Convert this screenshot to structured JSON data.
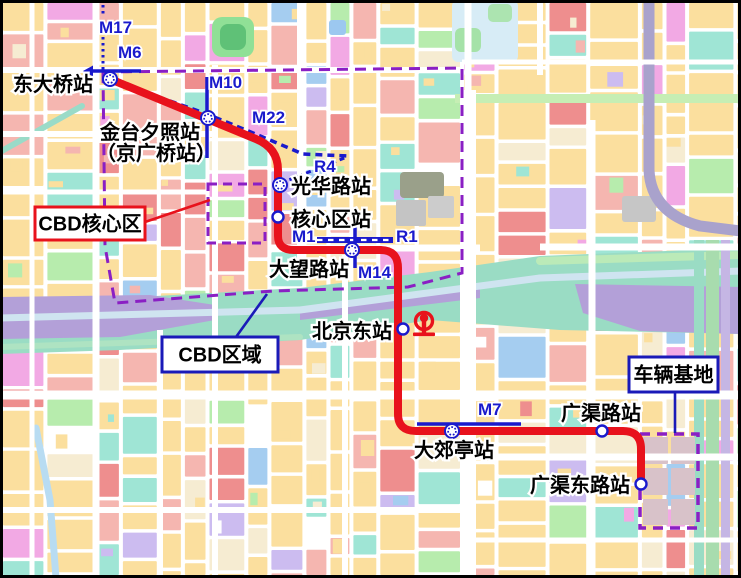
{
  "map": {
    "region_labels": {
      "core": "CBD核心区",
      "cbd": "CBD区域",
      "depot": "车辆基地"
    },
    "stations": [
      {
        "name": "东大桥站",
        "x": 110,
        "y": 79,
        "type": "interchange",
        "label": {
          "x": 13,
          "y": 91,
          "lines": [
            "东大桥站"
          ]
        }
      },
      {
        "name": "金台夕照站（京广桥站）",
        "x": 208,
        "y": 118,
        "type": "interchange",
        "label": {
          "x": 100,
          "y": 139,
          "lines": [
            "金台夕照站",
            "（京广桥站）"
          ],
          "x2": 96,
          "y2": 160
        }
      },
      {
        "name": "光华路站",
        "x": 280,
        "y": 185,
        "type": "interchange",
        "label": {
          "x": 291,
          "y": 193,
          "lines": [
            "光华路站"
          ]
        }
      },
      {
        "name": "核心区站",
        "x": 278,
        "y": 217,
        "type": "regular",
        "label": {
          "x": 291,
          "y": 226,
          "lines": [
            "核心区站"
          ]
        }
      },
      {
        "name": "大望路站",
        "x": 352,
        "y": 250,
        "type": "interchange",
        "label": {
          "x": 269,
          "y": 276,
          "lines": [
            "大望路站"
          ]
        }
      },
      {
        "name": "北京东站",
        "x": 403,
        "y": 329,
        "type": "regular",
        "label": {
          "x": 312,
          "y": 338,
          "lines": [
            "北京东站"
          ]
        }
      },
      {
        "name": "大郊亭站",
        "x": 452,
        "y": 431,
        "type": "interchange",
        "label": {
          "x": 414,
          "y": 457,
          "lines": [
            "大郊亭站"
          ]
        }
      },
      {
        "name": "广渠路站",
        "x": 602,
        "y": 431,
        "type": "regular",
        "label": {
          "x": 561,
          "y": 420,
          "lines": [
            "广渠路站"
          ]
        }
      },
      {
        "name": "广渠东路站",
        "x": 641,
        "y": 484,
        "type": "regular",
        "label": {
          "x": 530,
          "y": 492,
          "lines": [
            "广渠东路站"
          ]
        }
      }
    ],
    "line_labels": [
      {
        "text": "M17",
        "x": 99,
        "y": 33
      },
      {
        "text": "M6",
        "x": 118,
        "y": 58
      },
      {
        "text": "M10",
        "x": 209,
        "y": 88
      },
      {
        "text": "M22",
        "x": 252,
        "y": 123
      },
      {
        "text": "R4",
        "x": 314,
        "y": 172
      },
      {
        "text": "M1",
        "x": 292,
        "y": 242
      },
      {
        "text": "R1",
        "x": 396,
        "y": 242
      },
      {
        "text": "M14",
        "x": 358,
        "y": 278
      },
      {
        "text": "M7",
        "x": 478,
        "y": 415
      }
    ],
    "red_line": {
      "path": "M 110,79 L 256,139 Q 278,148 278,170 L 278,236 Q 278,250 294,250 L 380,250 Q 398,250 398,268 L 398,414 Q 398,431 416,431 L 623,431 Q 641,431 641,449 L 641,484"
    },
    "metro_lines": [
      {
        "id": "M17",
        "style": "dotted",
        "pts": [
          [
            103,
            5
          ],
          [
            103,
            17
          ]
        ]
      },
      {
        "id": "M17",
        "style": "dotted",
        "pts": [
          [
            103,
            37
          ],
          [
            103,
            71
          ]
        ]
      },
      {
        "id": "M6",
        "style": "solid",
        "pts": [
          [
            88,
            71
          ],
          [
            141,
            71
          ]
        ],
        "arrow": [
          [
            83,
            71
          ],
          [
            93,
            65.5
          ],
          [
            93,
            76.5
          ]
        ]
      },
      {
        "id": "M10",
        "style": "solid",
        "pts": [
          [
            207,
            77
          ],
          [
            207,
            158
          ]
        ]
      },
      {
        "id": "M22",
        "style": "dashed",
        "pts": [
          [
            113,
            81
          ],
          [
            207,
            114
          ],
          [
            258,
            135
          ],
          [
            303,
            154
          ],
          [
            348,
            156
          ]
        ]
      },
      {
        "id": "R4",
        "style": "dashed2",
        "pts": [
          [
            281,
            183
          ],
          [
            347,
            157
          ]
        ]
      },
      {
        "id": "M1/R1",
        "style": "dashdot",
        "pts": [
          [
            317,
            240
          ],
          [
            393,
            240
          ]
        ]
      },
      {
        "id": "M14",
        "style": "solid",
        "pts": [
          [
            355,
            221
          ],
          [
            355,
            268
          ]
        ]
      },
      {
        "id": "M7",
        "style": "solid",
        "pts": [
          [
            417,
            424
          ],
          [
            521,
            424
          ]
        ]
      }
    ],
    "boundaries": {
      "cbd_polygon": [
        [
          103,
          72
        ],
        [
          462,
          68
        ],
        [
          462,
          273
        ],
        [
          408,
          287
        ],
        [
          273,
          291
        ],
        [
          115,
          303
        ],
        [
          105,
          246
        ]
      ],
      "core_rect": {
        "x": 208,
        "y": 184,
        "w": 57,
        "h": 59
      },
      "depot_rect": {
        "x": 640,
        "y": 434,
        "w": 58,
        "h": 94
      }
    },
    "railway_icon": {
      "x": 424,
      "y": 321
    },
    "callouts": [
      {
        "key": "core",
        "box": {
          "x": 35,
          "y": 207,
          "w": 110,
          "h": 33
        },
        "border": "#e8121c",
        "leader": [
          [
            145,
            222
          ],
          [
            210,
            200
          ]
        ]
      },
      {
        "key": "cbd",
        "box": {
          "x": 162,
          "y": 337,
          "w": 116,
          "h": 35
        },
        "border": "#1a1ab8",
        "leader": [
          [
            236,
            337
          ],
          [
            267,
            294
          ]
        ]
      },
      {
        "key": "depot",
        "box": {
          "x": 629,
          "y": 357,
          "w": 89,
          "h": 35
        },
        "border": "#1a1ab8",
        "leader": [
          [
            675,
            392
          ],
          [
            675,
            433
          ]
        ]
      }
    ],
    "colors": {
      "metro_blue": "#1a1acc",
      "line_red": "#e8121c",
      "boundary_purple": "#8a1fc4",
      "callout_blue": "#1a1ab8",
      "palette": {
        "yellow": "#fbdf9e",
        "cream": "#f6ecd2",
        "pink": "#f5b6b0",
        "red": "#ee8e8e",
        "teal": "#9fe5d5",
        "green": "#b7ecad",
        "magenta": "#f2a9e4",
        "lavender": "#ccbcf0",
        "blue": "#a5cdf0"
      }
    },
    "features": [
      {
        "shape": "line",
        "x1": 0,
        "y1": 152,
        "x2": 82,
        "y2": 106,
        "w": 6,
        "color": "#9adbc8"
      },
      {
        "shape": "rect",
        "x": 212,
        "y": 17,
        "w": 42,
        "h": 40,
        "rx": 10,
        "color": "#90e096"
      },
      {
        "shape": "rect",
        "x": 220,
        "y": 24,
        "w": 26,
        "h": 26,
        "rx": 8,
        "color": "#5fc177"
      },
      {
        "shape": "rect",
        "x": 329,
        "y": 20,
        "w": 17,
        "h": 15,
        "rx": 3,
        "color": "#9cc8f0"
      },
      {
        "shape": "rect",
        "x": 452,
        "y": 0,
        "w": 66,
        "h": 62,
        "rx": 6,
        "color": "#d7ecf6"
      },
      {
        "shape": "rect",
        "x": 455,
        "y": 28,
        "w": 26,
        "h": 24,
        "rx": 6,
        "color": "#a5e2a8"
      },
      {
        "shape": "rect",
        "x": 488,
        "y": 4,
        "w": 24,
        "h": 18,
        "rx": 5,
        "color": "#ace4b0"
      },
      {
        "shape": "rect",
        "x": 455,
        "y": 94,
        "w": 286,
        "h": 9,
        "rx": 0,
        "color": "#c6eeb4"
      },
      {
        "shape": "rect",
        "x": 400,
        "y": 172,
        "w": 44,
        "h": 26,
        "rx": 4,
        "color": "#9aa08a"
      },
      {
        "shape": "rect",
        "x": 396,
        "y": 200,
        "w": 30,
        "h": 26,
        "rx": 2,
        "color": "#c4c4c4"
      },
      {
        "shape": "rect",
        "x": 428,
        "y": 196,
        "w": 26,
        "h": 22,
        "rx": 2,
        "color": "#cccccc"
      },
      {
        "shape": "rect",
        "x": 622,
        "y": 196,
        "w": 34,
        "h": 26,
        "rx": 3,
        "color": "#c6c6c6"
      },
      {
        "shape": "poly",
        "pts": [
          [
            0,
            300
          ],
          [
            120,
            298
          ],
          [
            300,
            288
          ],
          [
            430,
            272
          ],
          [
            540,
            256
          ],
          [
            741,
            248
          ],
          [
            741,
            334
          ],
          [
            560,
            330
          ],
          [
            430,
            320
          ],
          [
            300,
            340
          ],
          [
            120,
            350
          ],
          [
            0,
            354
          ]
        ],
        "color": "#9adcc4"
      },
      {
        "shape": "poly",
        "pts": [
          [
            0,
            297
          ],
          [
            150,
            295
          ],
          [
            215,
            305
          ],
          [
            215,
            320
          ],
          [
            120,
            337
          ],
          [
            0,
            339
          ]
        ],
        "color": "#b3a0d8"
      },
      {
        "shape": "poly",
        "pts": [
          [
            575,
            284
          ],
          [
            741,
            287
          ],
          [
            741,
            334
          ],
          [
            640,
            331
          ],
          [
            583,
            313
          ]
        ],
        "color": "#b3a0d8"
      },
      {
        "shape": "poly",
        "pts": [
          [
            300,
            308
          ],
          [
            480,
            287
          ],
          [
            480,
            298
          ],
          [
            300,
            320
          ]
        ],
        "color": "#b3a0d8"
      },
      {
        "shape": "line",
        "x1": 0,
        "y1": 318,
        "x2": 300,
        "y2": 310,
        "w": 7,
        "color": "#cfe4f0"
      },
      {
        "shape": "line",
        "x1": 300,
        "y1": 310,
        "x2": 540,
        "y2": 278,
        "w": 7,
        "color": "#cfe4f0"
      },
      {
        "shape": "line",
        "x1": 540,
        "y1": 278,
        "x2": 741,
        "y2": 271,
        "w": 7,
        "color": "#cfe4f0"
      },
      {
        "shape": "line",
        "x1": 540,
        "y1": 261,
        "x2": 741,
        "y2": 255,
        "w": 8,
        "color": "#bbeab8"
      },
      {
        "shape": "line",
        "x1": 0,
        "y1": 347,
        "x2": 300,
        "y2": 337,
        "w": 6,
        "color": "#aee3c2"
      },
      {
        "shape": "path",
        "dpath": "M 649,0 L 649,170 Q 651,213 700,226 L 741,231",
        "w": 11,
        "color": "#a9a2cc"
      },
      {
        "shape": "rect",
        "x": 694,
        "y": 240,
        "w": 10,
        "h": 338,
        "rx": 0,
        "color": "#9adcc4"
      },
      {
        "shape": "rect",
        "x": 706,
        "y": 240,
        "w": 13,
        "h": 338,
        "rx": 0,
        "color": "#a8dcae"
      },
      {
        "shape": "rect",
        "x": 721,
        "y": 240,
        "w": 9,
        "h": 338,
        "rx": 0,
        "color": "#c5b6e4"
      },
      {
        "shape": "path",
        "dpath": "M 36,428 L 50,500 L 56,578",
        "w": 7,
        "color": "#b8dcf2"
      },
      {
        "shape": "rect",
        "x": 643,
        "y": 437,
        "w": 25,
        "h": 27,
        "rx": 1,
        "color": "#d8c2c9"
      },
      {
        "shape": "rect",
        "x": 671,
        "y": 437,
        "w": 24,
        "h": 27,
        "rx": 1,
        "color": "#d8c2c9"
      },
      {
        "shape": "rect",
        "x": 643,
        "y": 468,
        "w": 25,
        "h": 27,
        "rx": 1,
        "color": "#d8c2c9"
      },
      {
        "shape": "rect",
        "x": 671,
        "y": 468,
        "w": 24,
        "h": 27,
        "rx": 1,
        "color": "#d8c2c9"
      },
      {
        "shape": "rect",
        "x": 643,
        "y": 499,
        "w": 25,
        "h": 26,
        "rx": 1,
        "color": "#d8c2c9"
      },
      {
        "shape": "rect",
        "x": 671,
        "y": 499,
        "w": 24,
        "h": 26,
        "rx": 1,
        "color": "#d8c2c9"
      }
    ]
  }
}
